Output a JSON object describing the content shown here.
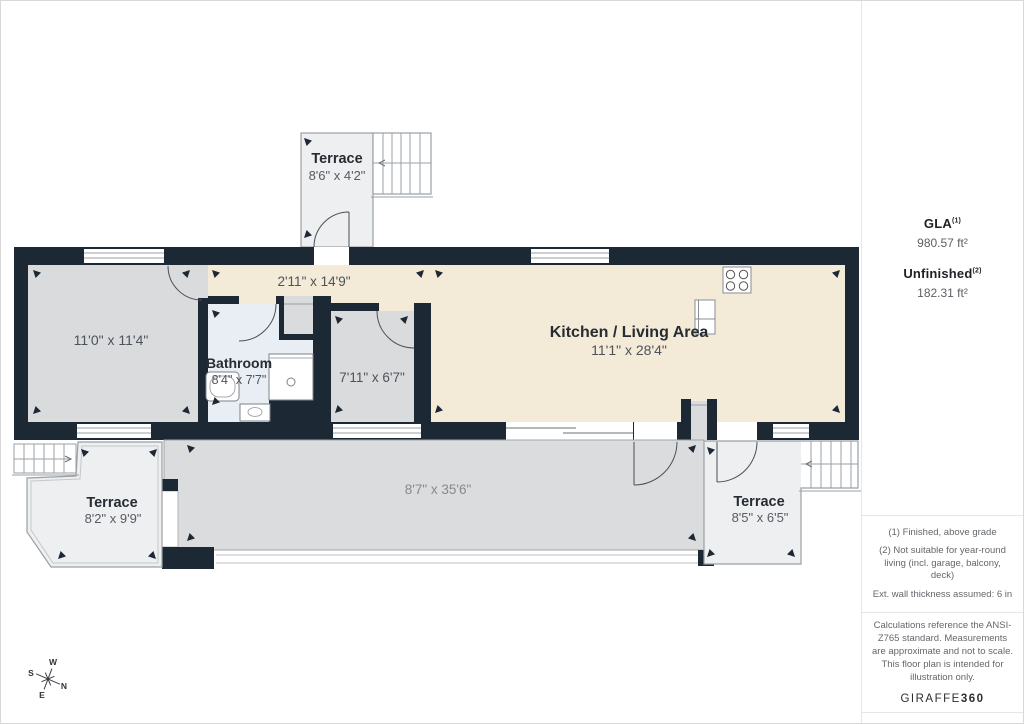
{
  "plan": {
    "rooms": {
      "terrace_top": {
        "name": "Terrace",
        "dims": "8'6\" x 4'2\""
      },
      "room_left": {
        "dims": "11'0\" x 11'4\""
      },
      "bathroom": {
        "name": "Bathroom",
        "dims": "8'4\" x 7'7\""
      },
      "hallway": {
        "dims": "2'11\" x 14'9\""
      },
      "room_small": {
        "dims": "7'11\" x 6'7\""
      },
      "kitchen_living": {
        "name": "Kitchen / Living Area",
        "dims": "11'1\" x 28'4\""
      },
      "deck": {
        "dims": "8'7\" x 35'6\""
      },
      "terrace_left": {
        "name": "Terrace",
        "dims": "8'2\" x 9'9\""
      },
      "terrace_right": {
        "name": "Terrace",
        "dims": "8'5\" x 6'5\""
      }
    },
    "compass": {
      "n": "N",
      "s": "S",
      "e": "E",
      "w": "W"
    },
    "colors": {
      "wall": "#1d2835",
      "kitchen_floor": "#f3ead7",
      "room_floor": "#d9dbdd",
      "bathroom_floor": "#e9eef4",
      "terrace_floor": "#edeff0",
      "deck_floor": "#dbdcde"
    }
  },
  "panel": {
    "gla": {
      "label": "GLA",
      "sup": "(1)",
      "value": "980.57 ft²"
    },
    "unfinished": {
      "label": "Unfinished",
      "sup": "(2)",
      "value": "182.31 ft²"
    },
    "footnotes": [
      "(1) Finished, above grade",
      "(2) Not suitable for year-round living (incl. garage, balcony, deck)",
      "Ext. wall thickness assumed: 6 in"
    ],
    "disclaimer": "Calculations reference the ANSI-Z765 standard. Measurements are approximate and not to scale. This floor plan is intended for illustration only.",
    "brand": {
      "name": "GIRAFFE",
      "suffix": "360"
    }
  }
}
